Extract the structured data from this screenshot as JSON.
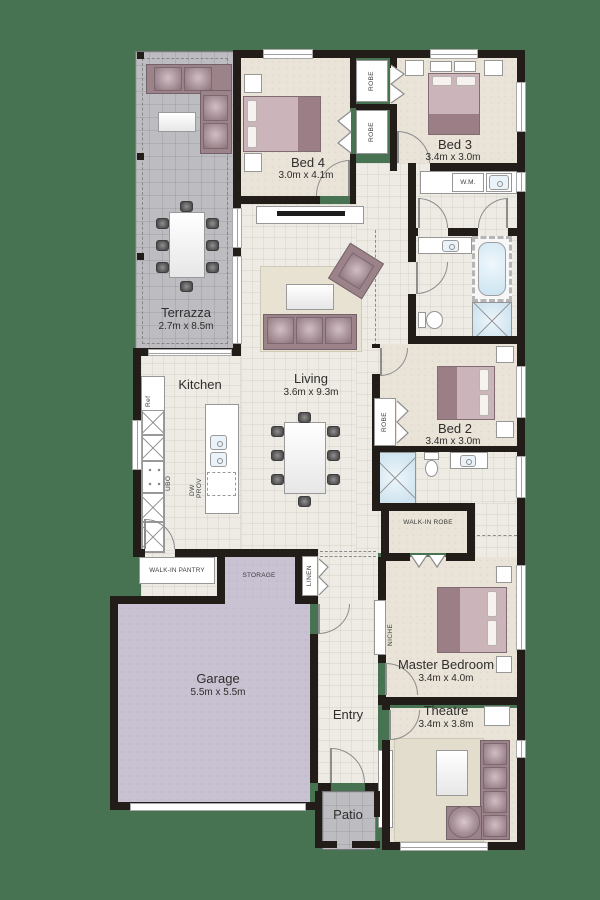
{
  "colors": {
    "background": "#487352",
    "wall": "#221d18",
    "carpet_floor": "#e9e3d8",
    "tile_floor": "#edebe4",
    "outdoor_floor": "#bcbcc1",
    "garage_floor": "#c8c2d3",
    "furniture_mauve": "#9c8389",
    "furniture_mauve_light": "#cbb5bb",
    "fixture_blue": "#d7e8f2",
    "rug": "#e7e2d1",
    "label_text": "#2f2e2c"
  },
  "rooms": {
    "terrazza": {
      "name": "Terrazza",
      "dims": "2.7m x 8.5m"
    },
    "bed4": {
      "name": "Bed 4",
      "dims": "3.0m x 4.1m"
    },
    "bed3": {
      "name": "Bed 3",
      "dims": "3.4m x 3.0m"
    },
    "living": {
      "name": "Living",
      "dims": "3.6m x 9.3m"
    },
    "kitchen": {
      "name": "Kitchen"
    },
    "bed2": {
      "name": "Bed 2",
      "dims": "3.4m x 3.0m"
    },
    "master_bedroom": {
      "name": "Master Bedroom",
      "dims": "3.4m x 4.0m"
    },
    "garage": {
      "name": "Garage",
      "dims": "5.5m x 5.5m"
    },
    "theatre": {
      "name": "Theatre",
      "dims": "3.4m x 3.8m"
    },
    "entry": {
      "name": "Entry"
    },
    "patio": {
      "name": "Patio"
    }
  },
  "labels": {
    "robe": "ROBE",
    "wm": "W.M.",
    "ref": "Ref",
    "ubo": "UBO",
    "dw": "DW",
    "prov": "PROV",
    "walk_in_pantry": "WALK-IN PANTRY",
    "storage": "STORAGE",
    "linen": "LINEN",
    "walk_in_robe": "WALK-IN ROBE",
    "niche": "NICHE"
  }
}
